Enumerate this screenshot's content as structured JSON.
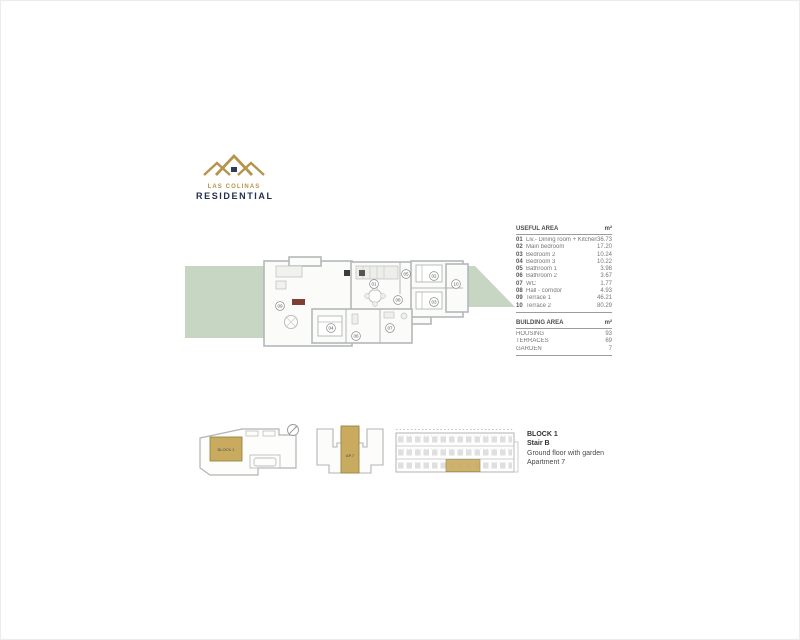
{
  "logo": {
    "name": "LAS COLINAS",
    "type": "RESIDENTIAL"
  },
  "useful_area": {
    "title": "USEFUL AREA",
    "unit": "m²",
    "rows": [
      {
        "num": "01",
        "label": "Liv.- Dining room + Kitchen",
        "value": "36.73"
      },
      {
        "num": "02",
        "label": "Main bedroom",
        "value": "17.20"
      },
      {
        "num": "03",
        "label": "Bedroom 2",
        "value": "10.24"
      },
      {
        "num": "04",
        "label": "Bedroom 3",
        "value": "10.22"
      },
      {
        "num": "05",
        "label": "Bathroom 1",
        "value": "3.98"
      },
      {
        "num": "06",
        "label": "Bathroom 2",
        "value": "3.67"
      },
      {
        "num": "07",
        "label": "WC",
        "value": "1.77"
      },
      {
        "num": "08",
        "label": "Hall - corridor",
        "value": "4.93"
      },
      {
        "num": "09",
        "label": "Terrace 1",
        "value": "46.21"
      },
      {
        "num": "10",
        "label": "Terrace 2",
        "value": "80.29"
      }
    ]
  },
  "building_area": {
    "title": "BUILDING AREA",
    "unit": "m²",
    "rows": [
      {
        "label": "HOUSING",
        "value": "93"
      },
      {
        "label": "TERRACES",
        "value": "69"
      },
      {
        "label": "GARDEN",
        "value": "7"
      }
    ]
  },
  "plan": {
    "markers": [
      "01",
      "02",
      "03",
      "04",
      "05",
      "06",
      "07",
      "08",
      "09",
      "10"
    ]
  },
  "site_plan": {
    "block_label": "BLOCK 1",
    "apartment_label": "AP.7"
  },
  "location": {
    "block": "BLOCK 1",
    "stair": "Stair B",
    "floor": "Ground floor with garden",
    "apartment": "Apartment 7"
  },
  "colors": {
    "gold": "#b9984e",
    "gold_fill": "#c8ab5f",
    "navy": "#22304e",
    "garden_green": "#c7d6c3",
    "wall_gray": "#b4b8b8",
    "accent_red": "#7d4033"
  }
}
